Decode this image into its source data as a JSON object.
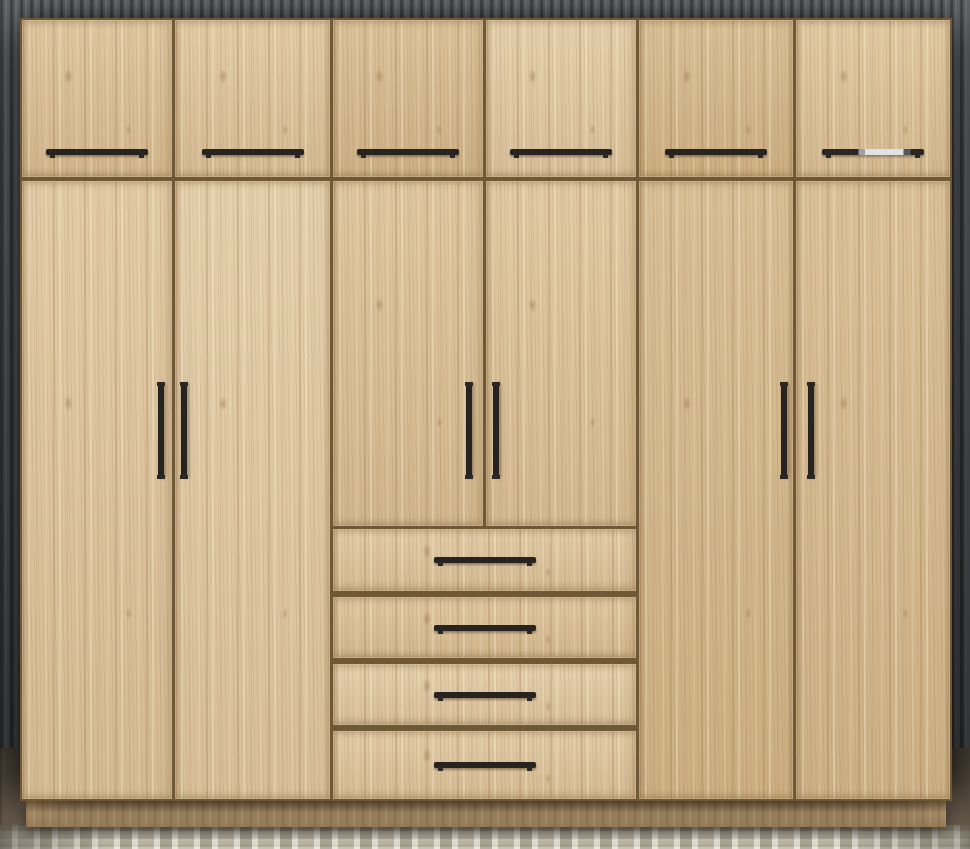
{
  "scene": {
    "description": "3D product render of a six-section light oak wardrobe with slim black bar handles, standing against a dark grey vertical-slat panel wall on a beige-grey checkered rug over a dark wood floor",
    "wardrobe": {
      "material": "light oak wood with vertical grain and knots",
      "top_cabinet_doors": 6,
      "tall_doors": 4,
      "half_doors": 2,
      "drawers": 4,
      "plinth": "recessed shadowed wooden base",
      "handles": {
        "style": "slim matte black bar",
        "top_row": "horizontal, centered near bottom edge of each top door",
        "tall_and_half_doors": "vertical, paired on both sides of the centre seams",
        "drawers": "horizontal, centered",
        "accent": "top-right door handle has a brushed-silver highlight section"
      }
    },
    "environment": {
      "wall": "dark grey vertical slat panelling",
      "floor": "dark brown wood",
      "rug": "beige-grey brick-pattern carpet with white weave lines"
    },
    "colors": {
      "wood_base": "#d8be96",
      "wood_grain_dark": "#926c42",
      "wood_grain_light": "#fff5d8",
      "seam": "#6e5836",
      "handle_black": "#272320",
      "handle_accent_silver": "#dfe3e6",
      "wall_grey": "#56595c",
      "wall_slat_shadow": "#36393b",
      "floor_brown": "#5a4f43",
      "carpet_base": "#ccc6b6",
      "carpet_accent": "#8f8a74",
      "plinth_shadowed_wood": "#a5875f"
    }
  }
}
